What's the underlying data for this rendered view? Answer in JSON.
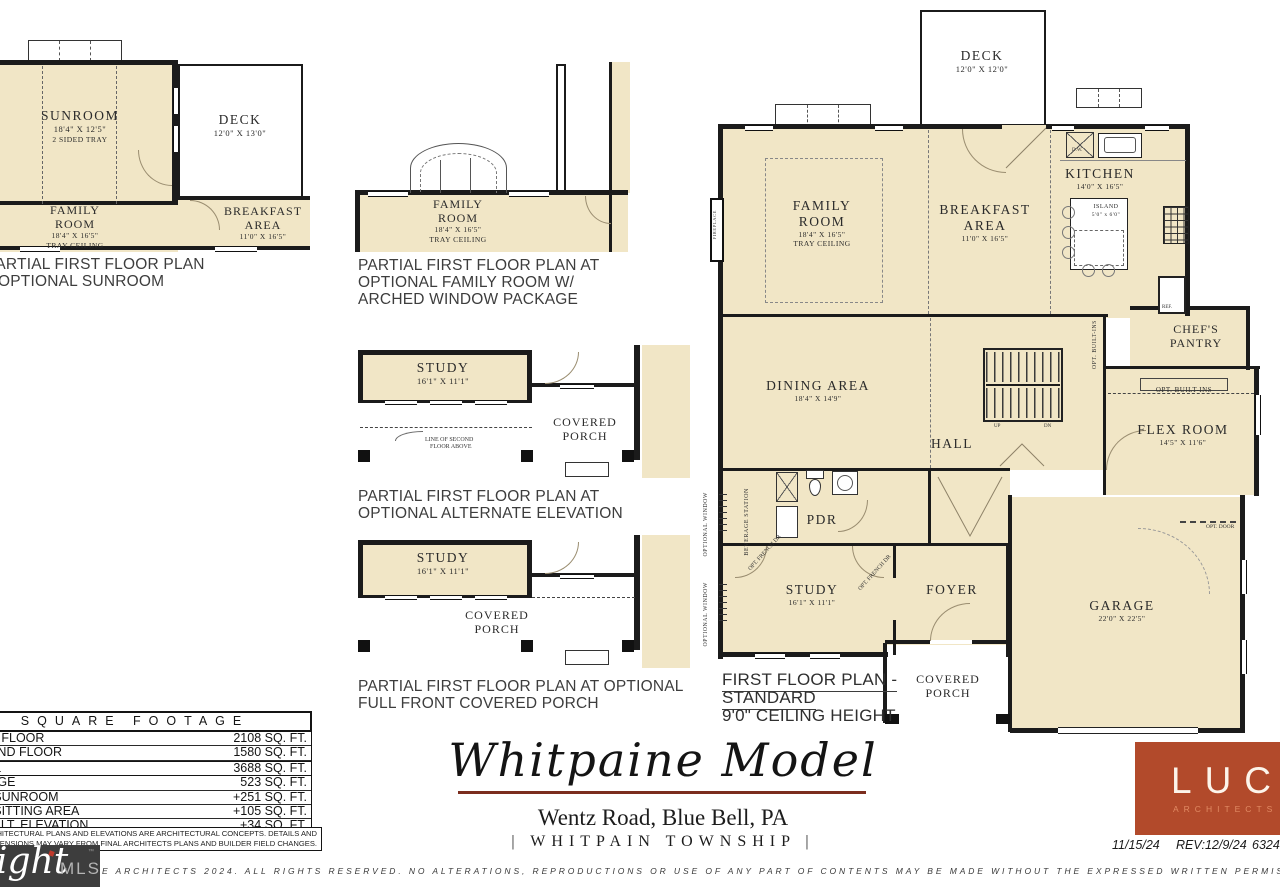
{
  "plan_a": {
    "caption1": "PARTIAL FIRST FLOOR PLAN",
    "caption2": "OPTIONAL SUNROOM",
    "sunroom": "SUNROOM",
    "sunroom_dims": "18'4\" X 12'5\"",
    "sunroom_note": "2 SIDED TRAY",
    "deck": "DECK",
    "deck_dims": "12'0\" X 13'0\"",
    "family1": "FAMILY",
    "family2": "ROOM",
    "family_dims": "18'4\" X 16'5\"",
    "family_note": "TRAY CEILING",
    "breakfast1": "BREAKFAST",
    "breakfast2": "AREA",
    "breakfast_dims": "11'0\" X 16'5\""
  },
  "plan_b": {
    "caption1": "PARTIAL FIRST FLOOR PLAN AT",
    "caption2": "OPTIONAL FAMILY ROOM W/",
    "caption3": "ARCHED WINDOW PACKAGE",
    "family1": "FAMILY",
    "family2": "ROOM",
    "family_dims": "18'4\" X 16'5\"",
    "family_note": "TRAY CEILING"
  },
  "plan_c": {
    "caption1": "PARTIAL FIRST FLOOR PLAN AT",
    "caption2": "OPTIONAL ALTERNATE ELEVATION",
    "study": "STUDY",
    "study_dims": "16'1\" X 11'1\"",
    "porch1": "COVERED",
    "porch2": "PORCH",
    "line_note1": "LINE OF SECOND",
    "line_note2": "FLOOR ABOVE"
  },
  "plan_d": {
    "caption1": "PARTIAL FIRST FLOOR PLAN AT OPTIONAL",
    "caption2": "FULL FRONT COVERED PORCH",
    "study": "STUDY",
    "study_dims": "16'1\" X 11'1\"",
    "porch1": "COVERED",
    "porch2": "PORCH"
  },
  "main": {
    "deck": "DECK",
    "deck_dims": "12'0\" X 12'0\"",
    "family1": "FAMILY",
    "family2": "ROOM",
    "family_dims": "18'4\" X 16'5\"",
    "family_note": "TRAY CEILING",
    "breakfast1": "BREAKFAST",
    "breakfast2": "AREA",
    "breakfast_dims": "11'0\" X 16'5\"",
    "kitchen": "KITCHEN",
    "kitchen_dims": "14'0\" X 16'5\"",
    "island1": "ISLAND",
    "island2": "5'0\" x 6'0\"",
    "dw": "D.W.",
    "ref": "REF.",
    "pantry1": "CHEF'S",
    "pantry2": "PANTRY",
    "opt_builtins": "OPT. BUILT-INS",
    "flex": "FLEX ROOM",
    "flex_dims": "14'5\" X 11'6\"",
    "dining": "DINING AREA",
    "dining_dims": "18'4\" X 14'9\"",
    "hall": "HALL",
    "up": "UP",
    "dn": "DN",
    "pdr": "PDR",
    "beverage": "BEVERAGE STATION",
    "opt_french": "OPT. FRENCH DR",
    "optional_window": "OPTIONAL WINDOW",
    "fireplace": "FIREPLACE",
    "study": "STUDY",
    "study_dims": "16'1\" X 11'1\"",
    "foyer": "FOYER",
    "porch1": "COVERED",
    "porch2": "PORCH",
    "garage": "GARAGE",
    "garage_dims": "22'0\" X 22'5\"",
    "opt_door": "OPT. DOOR",
    "caption1": "FIRST FLOOR PLAN -",
    "caption2": "STANDARD",
    "caption3": "9'0\" CEILING HEIGHT"
  },
  "sqft": {
    "header": "SQUARE FOOTAGE",
    "rows": [
      {
        "label": "FIRST FLOOR",
        "value": "2108 SQ. FT."
      },
      {
        "label": "SECOND FLOOR",
        "value": "1580 SQ. FT."
      },
      {
        "label": "TOTAL",
        "value": "3688 SQ. FT."
      },
      {
        "label": "GARAGE",
        "value": "523 SQ. FT."
      },
      {
        "label": "OPT. SUNROOM",
        "value": "+251 SQ. FT."
      },
      {
        "label": "OPT. SITTING AREA",
        "value": "+105 SQ. FT."
      },
      {
        "label": "OPT. ALT. ELEVATION",
        "value": "+34 SQ. FT."
      }
    ],
    "disclaimer1": "THE ARCHITECTURAL PLANS AND ELEVATIONS ARE ARCHITECTURAL CONCEPTS. DETAILS AND",
    "disclaimer2": "DIMENSIONS MAY VARY FROM FINAL ARCHITECTS PLANS AND BUILDER FIELD CHANGES."
  },
  "title_block": {
    "title": "Whitpaine Model",
    "address": "Wentz Road, Blue Bell, PA",
    "township": "| WHITPAIN TOWNSHIP |"
  },
  "logo": {
    "brand": "LUCE",
    "sub": "ARCHITECTS",
    "date": "11/15/24",
    "rev": "REV:12/9/24",
    "job": "6324"
  },
  "watermark": {
    "script": "ight",
    "mls": "MLS",
    "tm": "™"
  },
  "copyright": "E ARCHITECTS 2024.  ALL RIGHTS RESERVED.  NO ALTERATIONS, REPRODUCTIONS OR USE OF ANY PART OF CONTENTS MAY BE MADE WITHOUT THE EXPRESSED WRITTEN PERMISSION OF THE AU"
}
